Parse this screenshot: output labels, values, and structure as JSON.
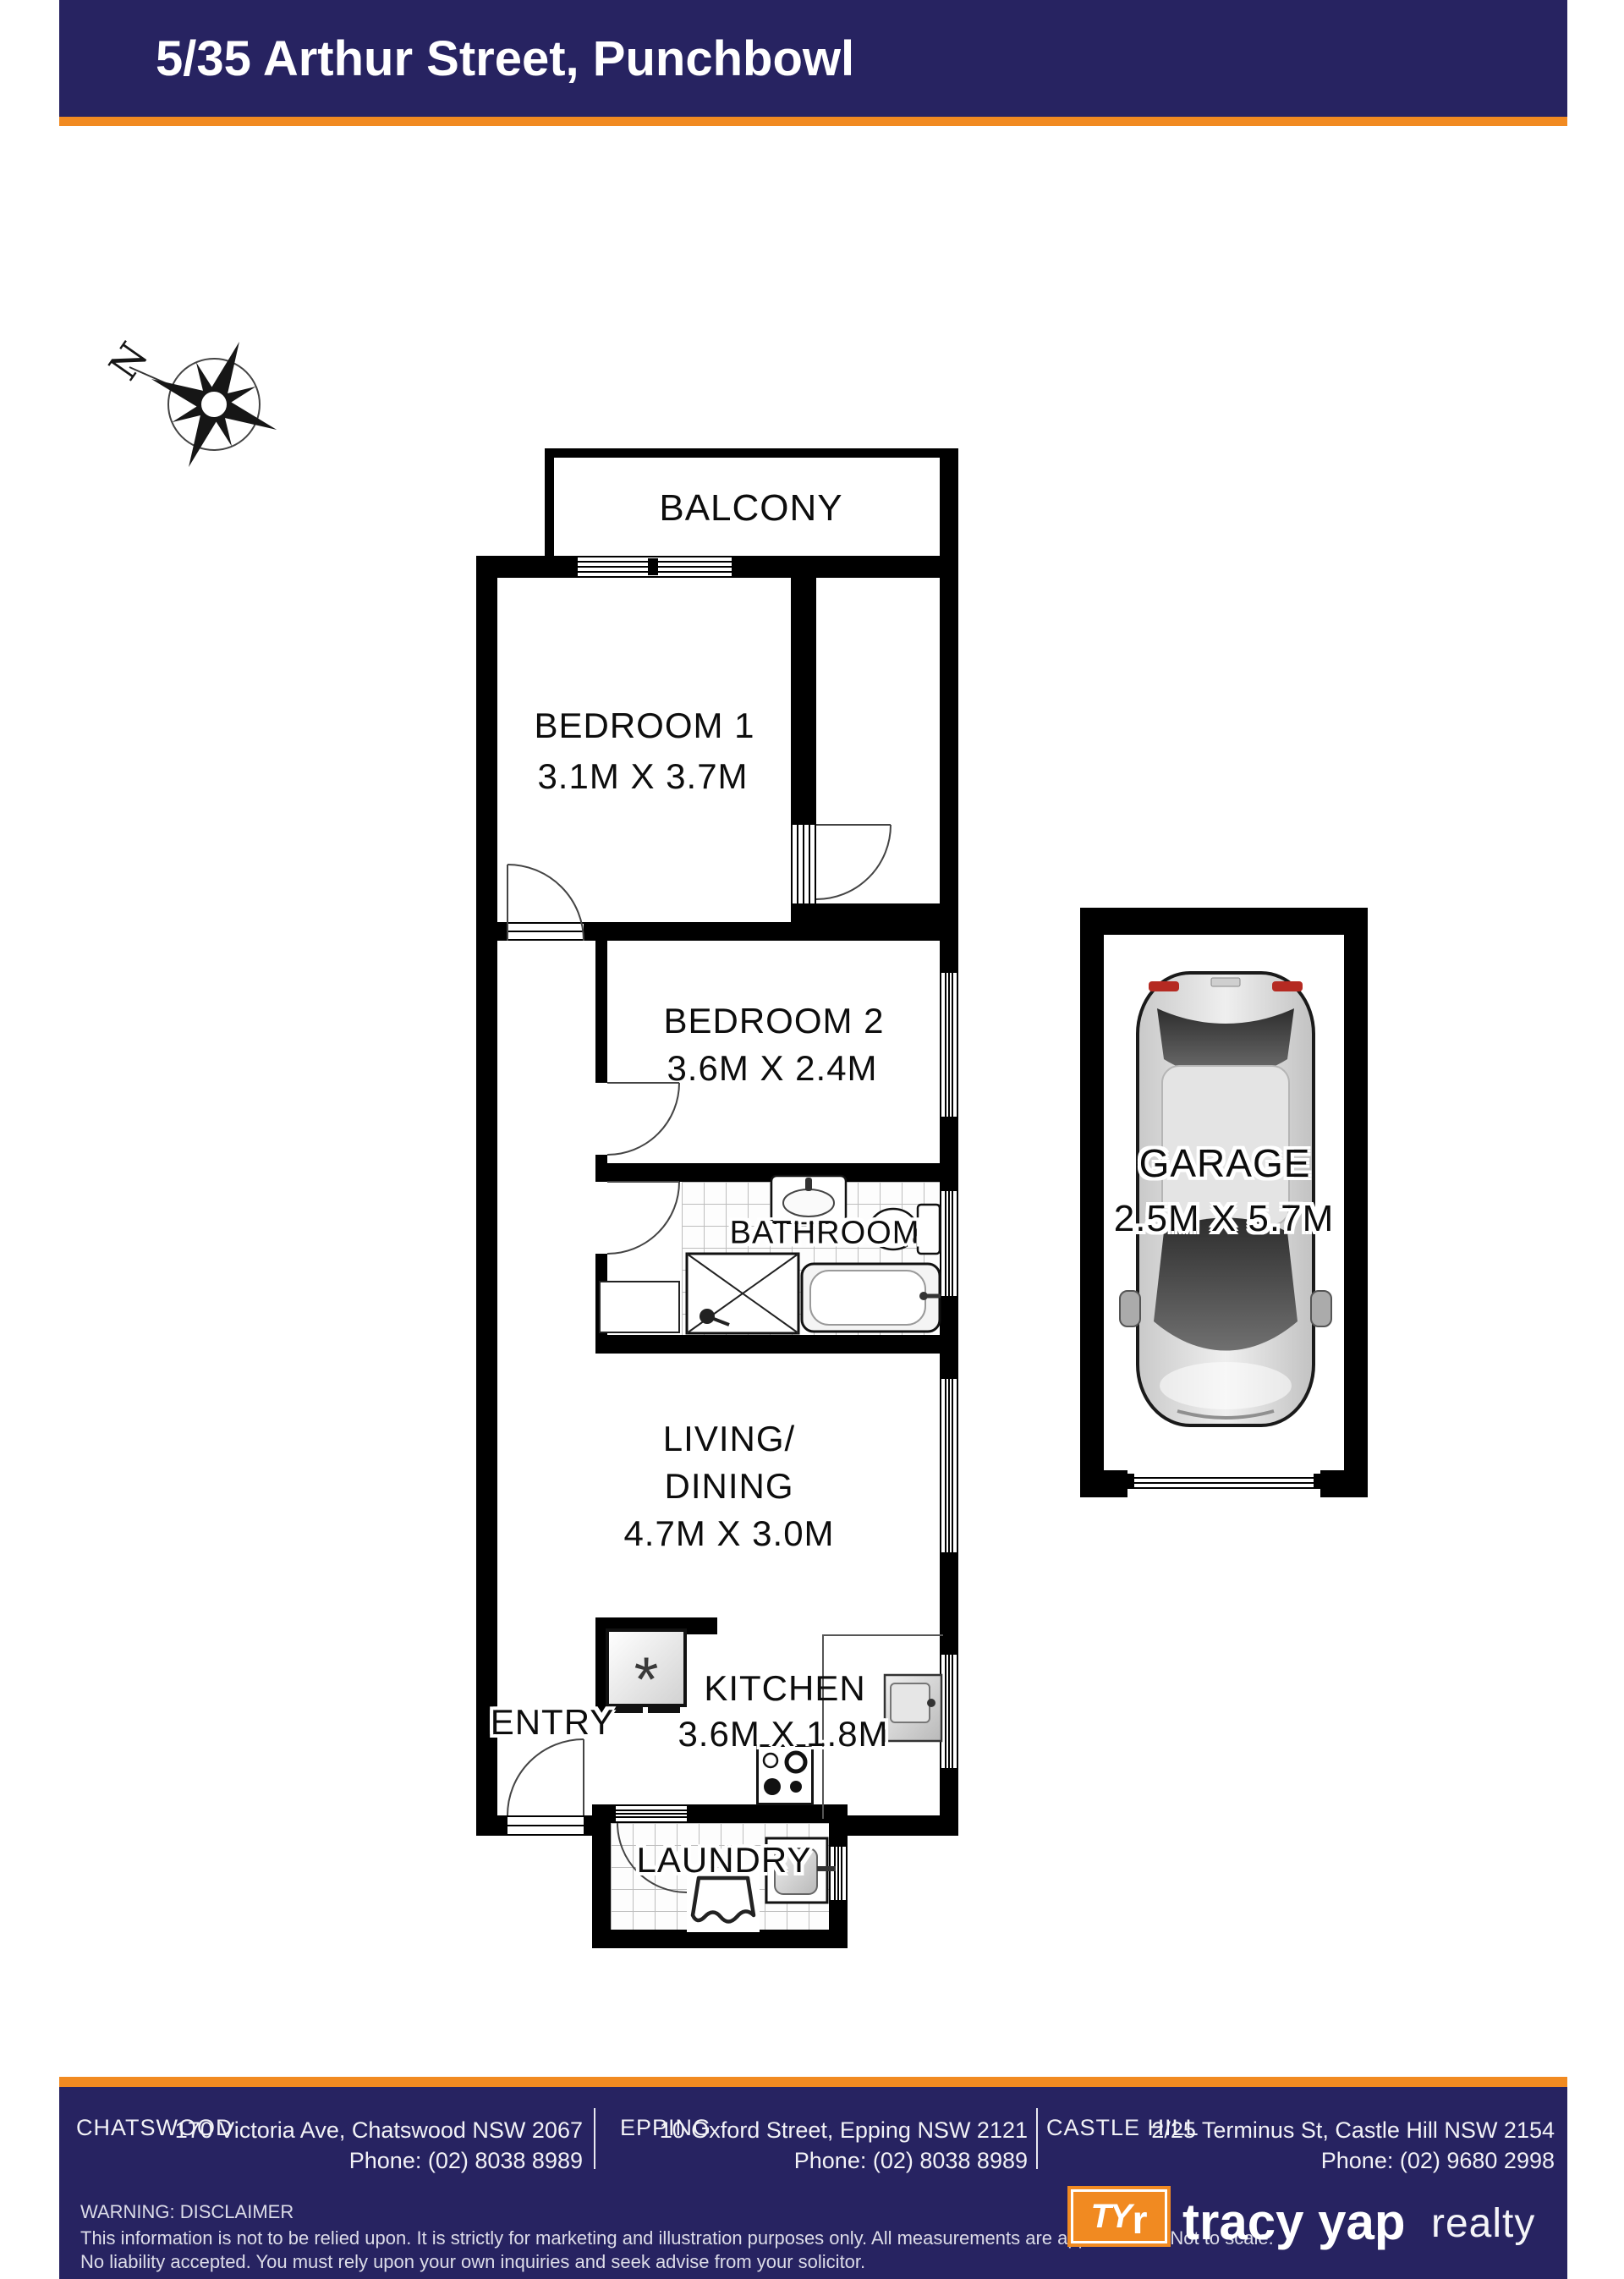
{
  "header": {
    "title": "5/35 Arthur Street, Punchbowl"
  },
  "compass": {
    "label": "N"
  },
  "rooms": {
    "balcony": {
      "name": "BALCONY"
    },
    "bedroom1": {
      "name": "BEDROOM 1",
      "dims": "3.1M X 3.7M"
    },
    "bedroom2": {
      "name": "BEDROOM 2",
      "dims": "3.6M X 2.4M"
    },
    "bathroom": {
      "name": "BATHROOM"
    },
    "living": {
      "name_line1": "LIVING/",
      "name_line2": "DINING",
      "dims": "4.7M X 3.0M"
    },
    "entry": {
      "name": "ENTRY"
    },
    "kitchen": {
      "name": "KITCHEN",
      "dims": "3.6M X 1.8M"
    },
    "laundry": {
      "name": "LAUNDRY"
    },
    "garage": {
      "name": "GARAGE",
      "dims": "2.5M X 5.7M"
    }
  },
  "icons": {
    "fridge_glyph": "*"
  },
  "footer": {
    "offices": [
      {
        "name": "CHATSWOOD",
        "address": "170 Victoria Ave, Chatswood NSW 2067",
        "phone": "Phone: (02) 8038 8989"
      },
      {
        "name": "EPPING",
        "address": "10 Oxford Street, Epping NSW 2121",
        "phone": "Phone: (02) 8038 8989"
      },
      {
        "name": "CASTLE HILL",
        "address": "2/25 Terminus St, Castle Hill NSW 2154",
        "phone": "Phone: (02) 9680 2998"
      }
    ],
    "disclaimer": {
      "title": "WARNING: DISCLAIMER",
      "line1": "This information is not to be relied upon. It is strictly for marketing and illustration purposes only. All measurements are approximate. Not to scale.",
      "line2": "No liability accepted. You must rely upon your own inquiries and seek advise from your solicitor."
    },
    "brand": {
      "mono_ty": "TY",
      "mono_r": "r",
      "name": "tracy yap",
      "suffix": "realty"
    }
  },
  "colors": {
    "navy": "#272361",
    "orange": "#f18a21",
    "wall": "#000000"
  }
}
